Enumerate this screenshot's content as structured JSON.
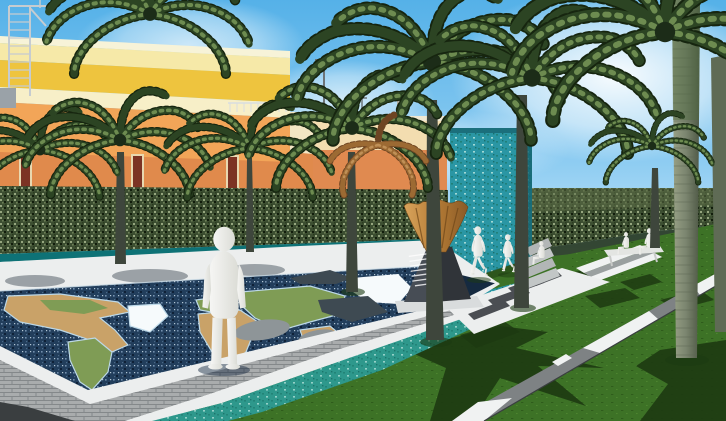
{
  "title": "3D architectural rendering of a tropical memorial plaza with world-map pool",
  "colors": {
    "sky_top": "#55b1e8",
    "sky_horizon": "#e6f5fd",
    "cloud": "#ffffff",
    "bldg_parapet": "#f7f3d8",
    "bldg_band_pale": "#f6e9a8",
    "bldg_band_gold": "#eec43e",
    "bldg_band_cream": "#f7efc8",
    "bldg_orange": "#f2a558",
    "bldg_orange_deep": "#e08a4c",
    "door_red": "#7c3324",
    "wing_cream": "#f3e6c4",
    "mid_parapet": "#efe8d2",
    "mid_cream": "#f3ddb0",
    "mid_orange": "#e08a50",
    "scaffold_gray": "#c6ccd0",
    "pole_gray": "#6d7478",
    "hedge_base": "#3c4e31",
    "hedge_top_light": "#5c6e47",
    "hedge_shadow": "#1a2a10",
    "coping_teal": "#0e7276",
    "base_wall": "#a6adad",
    "teal_wall": "#2a96a4",
    "grass": "#3d7226",
    "grass_strip": "#2f5f1d",
    "grass_shadow": "#1d3a12",
    "water": "#223e5c",
    "deck_white": "#eceeee",
    "deck_shade": "#5a646d",
    "brick": "#a9acad",
    "teal_channel": "#2e988c",
    "dark_pavement": "#3a3e40",
    "continent_tan": "#c9a268",
    "continent_green": "#7f9c55",
    "ice_white": "#f6fafc",
    "whale_gray": "#3e4a52",
    "rock_gray": "#8e9598",
    "plinth_light": "#474d55",
    "plinth_dark": "#303439",
    "monument_base": "#d9dcdd",
    "bronze": "#c08744",
    "bronze_dark": "#6e4618",
    "figure_white": "#f2f2ef",
    "bench_white": "#e3e5e2",
    "path_gray": "#7e8284",
    "path_white": "#f0f2f2",
    "trunk": "#3e463c",
    "trunk_big": "#7b856f",
    "frond_green": "#2c4423",
    "frond_light": "#6d8b50",
    "frond_dead": "#9c6a33"
  },
  "scene": {
    "sky": {
      "description": "clear blue sky with soft white clouds"
    },
    "buildings": [
      {
        "name": "left building",
        "bands": [
          "white parapet",
          "pale yellow",
          "golden yellow",
          "cream",
          "orange"
        ],
        "details": [
          "rooftop scaffold ladder",
          "roof railing",
          "three dark red doors"
        ]
      },
      {
        "name": "middle building",
        "bands": [
          "white parapet",
          "cream",
          "orange"
        ],
        "details": [
          "rooftop box",
          "chimney",
          "street light pole",
          "small mast"
        ]
      }
    ],
    "vegetation": {
      "palm_trees": 10,
      "dead_brown_palm": 1,
      "hedges": [
        "left perimeter hedge with teal coping",
        "right perimeter hedge"
      ]
    },
    "water_features": [
      {
        "name": "world map pool",
        "description": "dark mosaic reflecting pool shaped like a world map",
        "continents_visible": [
          "North America",
          "Greenland",
          "South America",
          "Europe",
          "Africa",
          "Asia",
          "Australia"
        ],
        "sculptures": [
          "white iceberg",
          "two whale silhouettes"
        ]
      },
      {
        "name": "waterfall wall",
        "description": "tall turquoise textured water wall"
      },
      {
        "name": "perimeter stream",
        "description": "narrow teal channel between pool deck and lawn"
      }
    ],
    "monument": {
      "parts": [
        "bronze flame sculpture",
        "dark stone pyramid plinth",
        "white base slab"
      ],
      "plaque_legible": false,
      "plaque_line_count": 7
    },
    "figures": [
      {
        "pose": "standing",
        "location": "on world map pool"
      },
      {
        "pose": "walking",
        "location": "lawn near waterfall wall"
      },
      {
        "pose": "walking",
        "location": "lawn near waterfall wall"
      },
      {
        "pose": "seated",
        "location": "terrace steps"
      },
      {
        "pose": "seated",
        "location": "bench left seat"
      },
      {
        "pose": "seated",
        "location": "bench right seat"
      }
    ],
    "hardscape": [
      "white pool deck",
      "gray brick retaining wall",
      "white chevron plaza paving",
      "terrace steps",
      "diagonal walkway with white pavers",
      "dark corner pavement",
      "park bench"
    ]
  }
}
